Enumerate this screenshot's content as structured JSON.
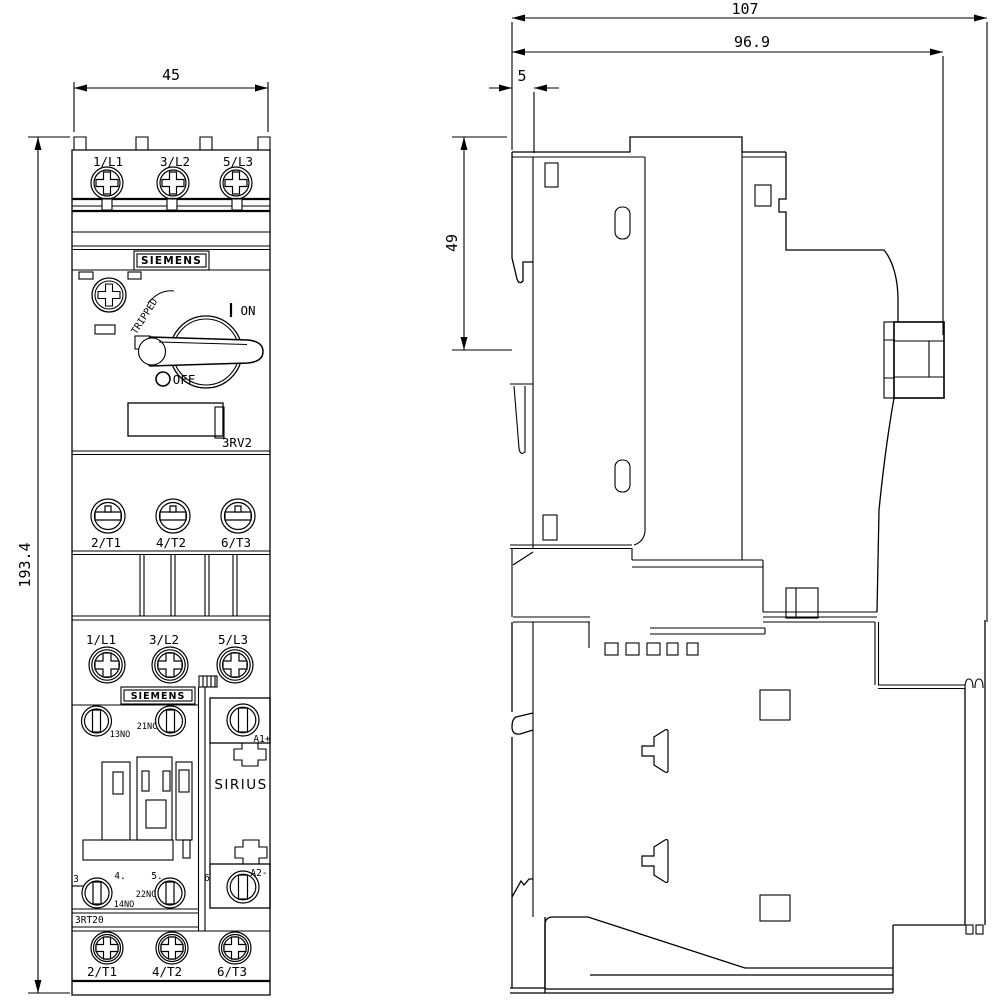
{
  "front_view": {
    "breaker": {
      "brand": "SIEMENS",
      "model": "3RV2",
      "line_terminals": [
        "1/L1",
        "3/L2",
        "5/L3"
      ],
      "load_terminals": [
        "2/T1",
        "4/T2",
        "6/T3"
      ],
      "on_label": "ON",
      "off_label": "OFF",
      "tripped_label": "TRIPPED"
    },
    "contactor": {
      "brand": "SIEMENS",
      "series": "SIRIUS",
      "model": "3RT20",
      "line_terminals": [
        "1/L1",
        "3/L2",
        "5/L3"
      ],
      "load_terminals": [
        "2/T1",
        "4/T2",
        "6/T3"
      ],
      "aux_no_top": "13NO",
      "aux_nc_top": "21NC",
      "coil_a1": "A1+",
      "aux_nc_bottom": "22NC",
      "aux_no_bottom": "14NO",
      "coil_a2": "A2-",
      "positions": [
        "3",
        "4.",
        "5.",
        "6"
      ]
    }
  },
  "dimensions": {
    "front_width": "45",
    "total_height": "193.4",
    "total_depth": "107",
    "body_depth": "96.9",
    "rail_offset": "5",
    "upper_height": "49"
  },
  "colors": {
    "line": "#000000",
    "background": "#ffffff"
  }
}
